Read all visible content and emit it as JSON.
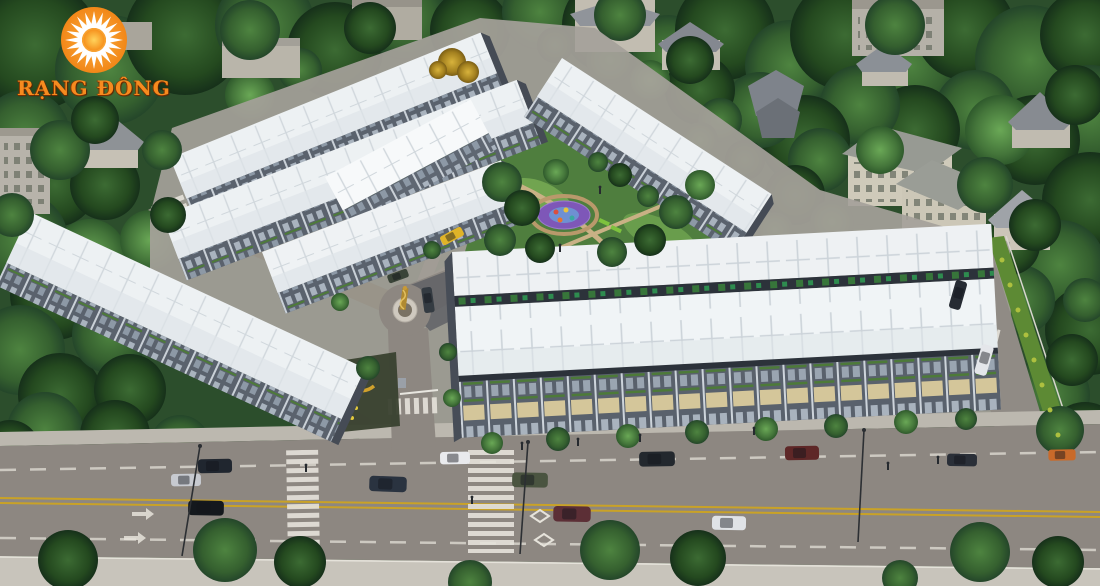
{
  "logo": {
    "brand": "RẠNG ĐÔNG",
    "sun_color": "#F6921E",
    "text_color": "#F68B1F"
  },
  "scene": {
    "type": "aerial-3d-architectural-render",
    "subject": "Townhouse / shophouse residential development with central playground park, entrance roundabout with monument, tree-lined boulevard with zebra crossings and cars, surrounded by dense tree canopy, villas and a school building",
    "elements": [
      "townhouse-rows-white-roofs",
      "foreground-double-row-block",
      "central-park-playground",
      "roundabout-monument",
      "entrance-gate-sign",
      "main-boulevard",
      "zebra-crossings",
      "lane-markings",
      "cars",
      "street-trees",
      "background-villas",
      "school-building",
      "tree-canopy"
    ],
    "palette": {
      "tree_dark": "#1d3e1f",
      "tree_mid": "#3c6b33",
      "tree_light": "#6aa856",
      "tree_autumn": "#c8a13a",
      "roof_white": "#edf1f3",
      "facade_gray": "#5a626d",
      "parapet_dark": "#2c323a",
      "road_gray": "#8d8781",
      "sidewalk": "#c6c2b9",
      "lane_yellow": "#c9a227",
      "playground_purple": "#7e57b8",
      "park_green": "#4f7e3e",
      "sign_gold": "#d8a72c"
    }
  }
}
